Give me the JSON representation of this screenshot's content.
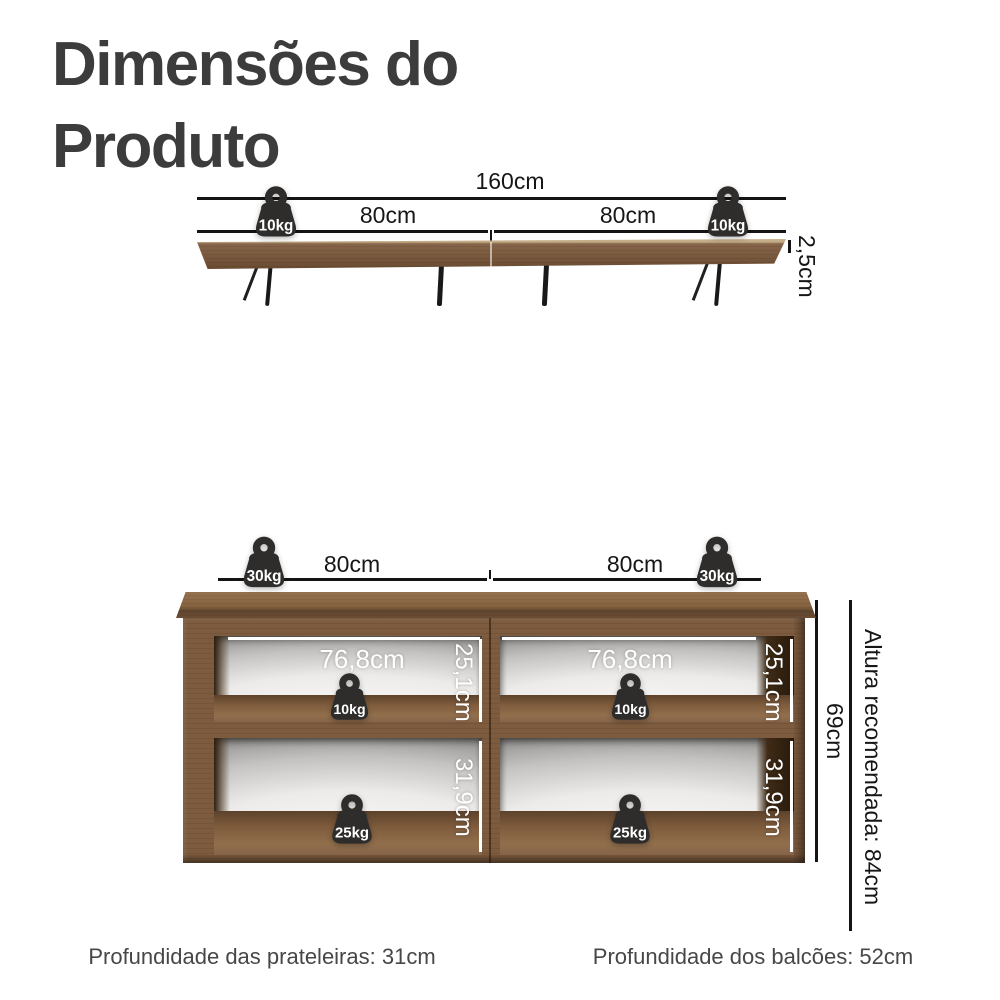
{
  "title": {
    "line1": "Dimensões do",
    "line2": "Produto"
  },
  "shelf": {
    "total_width": "160cm",
    "left_span": "80cm",
    "right_span": "80cm",
    "left_weight": "10kg",
    "right_weight": "10kg",
    "thickness": "2,5cm"
  },
  "cabinet": {
    "left_span": "80cm",
    "right_span": "80cm",
    "left_top_weight": "30kg",
    "right_top_weight": "30kg",
    "top_left_compartment": {
      "width": "76,8cm",
      "height": "25,1cm",
      "weight": "10kg"
    },
    "top_right_compartment": {
      "width": "76,8cm",
      "height": "25,1cm",
      "weight": "10kg"
    },
    "bottom_left_compartment": {
      "height": "31,9cm",
      "weight": "25kg"
    },
    "bottom_right_compartment": {
      "height": "31,9cm",
      "weight": "25kg"
    },
    "total_height": "69cm",
    "recommended_height": "Altura recomendada: 84cm"
  },
  "footer": {
    "shelves_depth": "Profundidade das prateleiras: 31cm",
    "cabinets_depth": "Profundidade dos balcões: 52cm"
  },
  "colors": {
    "wood": "#7d5b3e",
    "wood_light": "#c8b18c",
    "badge_dark": "#2e2d2b",
    "dimension_line": "#141414",
    "title_text": "#3c3c3c",
    "white_dimension": "#ffffff"
  }
}
